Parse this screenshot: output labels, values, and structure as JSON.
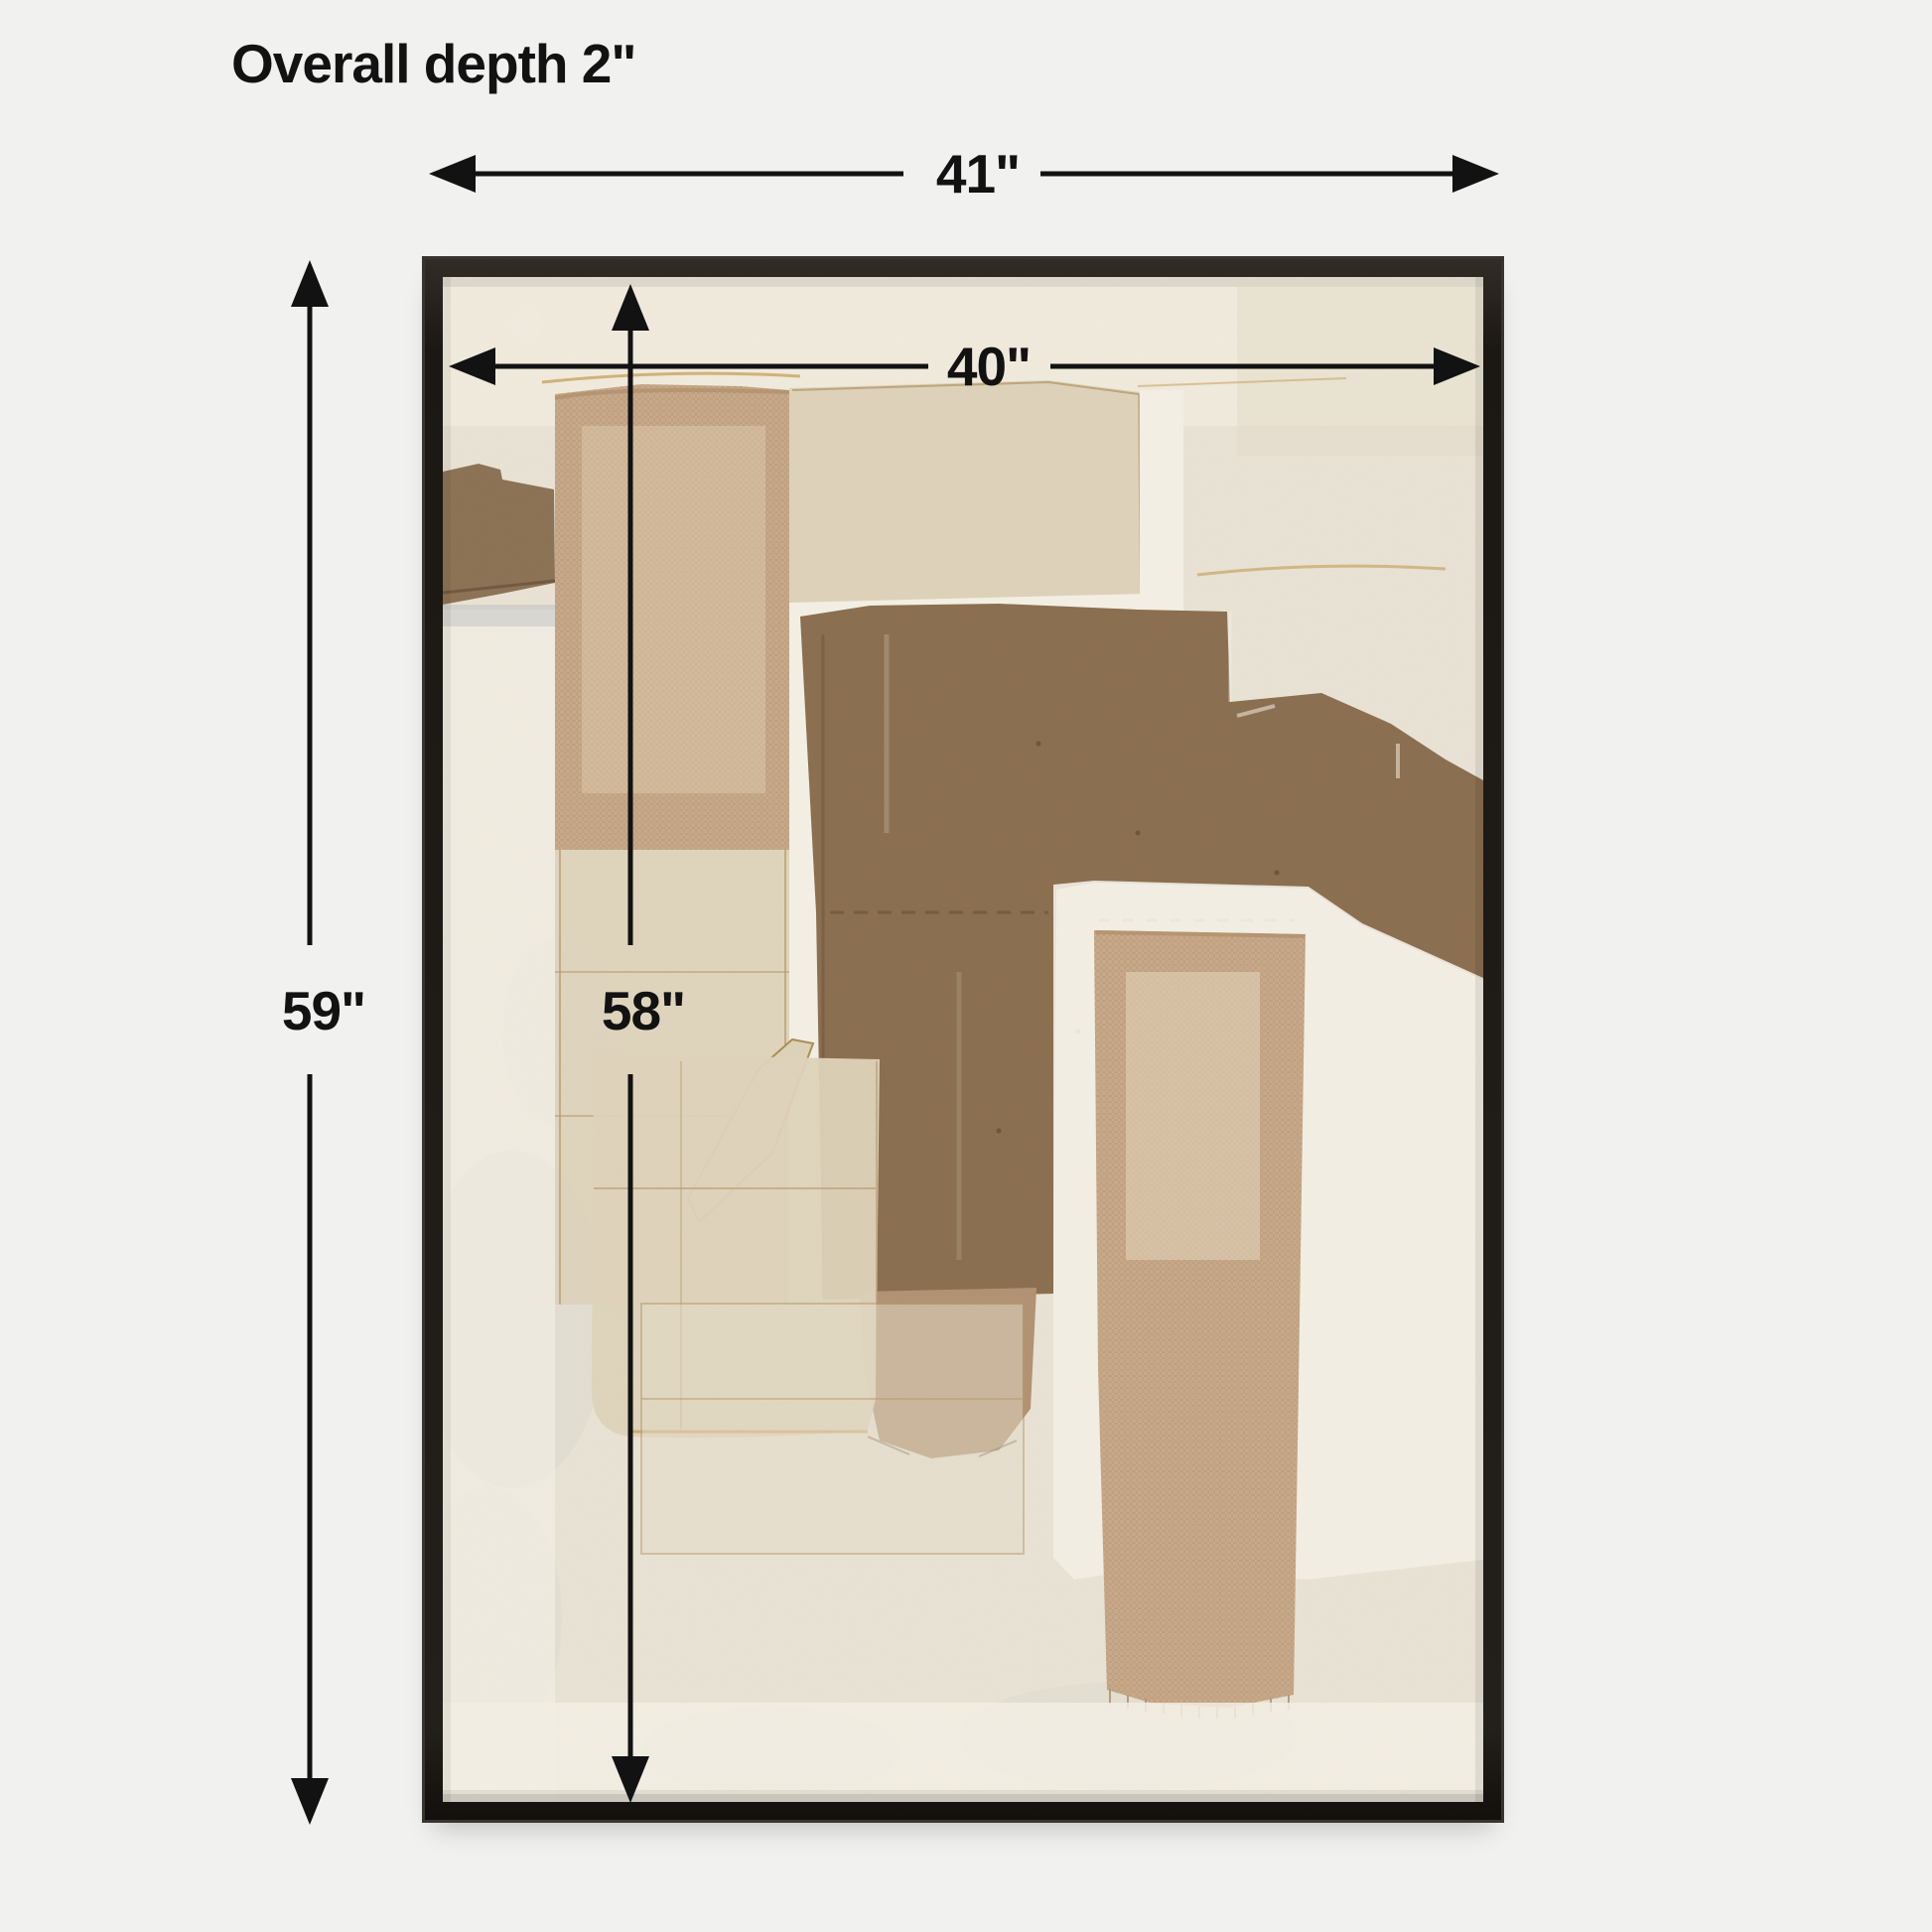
{
  "title": {
    "depth_note": "Overall depth 2\""
  },
  "dimensions": {
    "outer_width": "41\"",
    "inner_width": "40\"",
    "outer_height": "59\"",
    "inner_height": "58\""
  },
  "artwork": {
    "frame_style": "thin-black-float-frame",
    "media_names": [
      "canvas-background",
      "burlap-strip-left",
      "burlap-strip-right",
      "paper-patch-top",
      "brown-field",
      "tan-column",
      "paper-column-left",
      "paper-patch-bottom",
      "sketch-outline-rect",
      "left-brown-patch"
    ]
  },
  "palette": {
    "page-bg": "#f1f1f0",
    "ink": "#121212",
    "frame": "#201c18",
    "frame-hi": "#3a342e",
    "canvas-cream": "#e9e3d5",
    "canvas-light": "#f1ecdf",
    "white-wash": "#f4f0e5",
    "burlap": "#c7a88a",
    "burlap-thread": "#b2916c",
    "burlap-light": "#eadcc4",
    "beige": "#ded3ba",
    "beige-line": "#b59a6d",
    "brown": "#8a6e4f",
    "brown-patch": "#8c7254",
    "brown-dark": "#5e4930",
    "tan": "#b19273",
    "gold": "#c49a50",
    "gray-wash": "#c9cec9"
  }
}
